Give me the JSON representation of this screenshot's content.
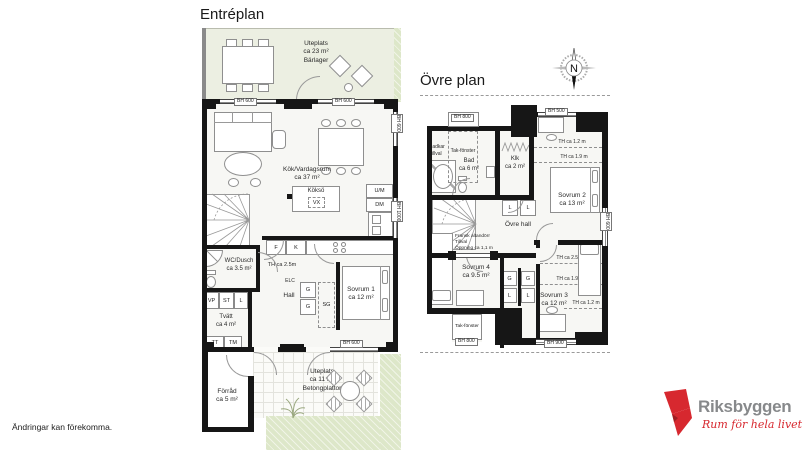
{
  "colors": {
    "wall": "#161616",
    "terrace": "#ecefe2",
    "grass": "#dde7c9",
    "accent_red": "#d7282f",
    "logo_gray": "#87898b"
  },
  "footer": {
    "disclaimer": "Ändringar kan förekomma."
  },
  "brand": {
    "name": "Riksbyggen",
    "tagline": "Rum för hela livet"
  },
  "compass": {
    "north": "N"
  },
  "entre": {
    "title": "Entréplan",
    "uteplats_top": {
      "name": "Uteplats",
      "area": "ca 23 m²",
      "note": "Bärlager"
    },
    "livingroom": {
      "name": "Kök/Vardagsrum",
      "area": "ca 37 m²"
    },
    "island": {
      "name": "Köksö",
      "vx": "VX"
    },
    "appliances": {
      "um": "U/M",
      "dm": "DM",
      "f": "F",
      "k": "K"
    },
    "th": "TH ca 2.5m",
    "elc": "ELC",
    "wc": {
      "name": "WC/Dusch",
      "area": "ca 3.5 m²"
    },
    "closets": {
      "vp": "VP",
      "st": "ST",
      "l": "L",
      "g": "G",
      "sg": "SG",
      "tt": "TT",
      "tm": "TM"
    },
    "hall": "Hall",
    "laundry": {
      "name": "Tvätt",
      "area": "ca 4 m²"
    },
    "bedroom1": {
      "name": "Sovrum 1",
      "area": "ca 12 m²"
    },
    "storage": {
      "name": "Förråd",
      "area": "ca 5 m²"
    },
    "uteplats_bottom": {
      "name": "Uteplats",
      "area": "ca 11 m²",
      "note": "Betongplattor"
    },
    "windows": {
      "bh600": "BH 600",
      "bh1000": "BH 1000"
    }
  },
  "ovre": {
    "title": "Övre plan",
    "windows": {
      "bh500": "BH 500",
      "bh600": "BH 600",
      "bh800": "BH 800",
      "bh900": "BH 900"
    },
    "skylight": "Tak-fönster",
    "bath": {
      "name": "Bad",
      "area": "ca 6 m²",
      "option1": "Badkar",
      "option2": "Tillval"
    },
    "klk": {
      "name": "Klk",
      "area": "ca 2 m²"
    },
    "bedroom2": {
      "name": "Sovrum 2",
      "area": "ca 13 m²"
    },
    "bedroom3": {
      "name": "Sovrum 3",
      "area": "ca 12 m²"
    },
    "bedroom4": {
      "name": "Sovrum 4",
      "area": "ca 9.5 m²"
    },
    "hall": "Övre hall",
    "french_door": {
      "l1": "Fransk altandörr",
      "l2": "Tillval",
      "l3": "Öppning ca 1,1 m"
    },
    "heights": {
      "th12": "TH ca 1.2 m",
      "th19": "TH ca 1.9 m",
      "th25": "TH ca 2.5 m"
    }
  }
}
